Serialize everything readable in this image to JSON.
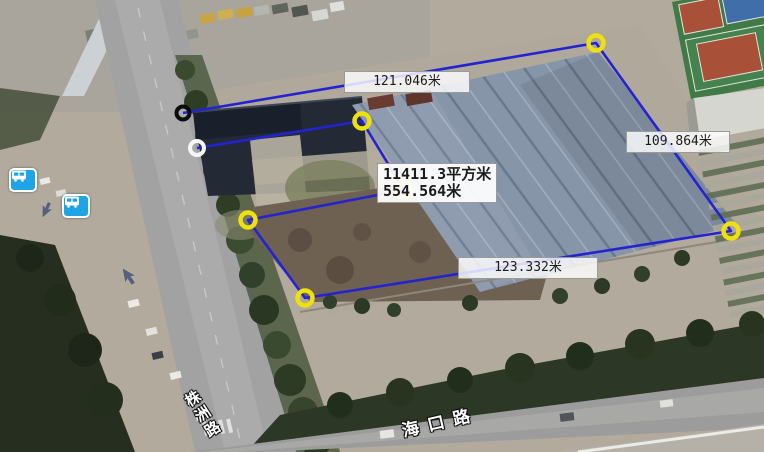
{
  "map": {
    "view": "satellite",
    "measurement": {
      "area_text": "11411.3平方米",
      "perimeter_text": "554.564米",
      "edge_labels": [
        {
          "text": "121.046米"
        },
        {
          "text": "109.864米"
        },
        {
          "text": "123.332米"
        }
      ],
      "line_color": "#2323d2",
      "marker_colors": {
        "start": "#0c0c0c",
        "white": "#f8f8f8",
        "default": "#efe10e"
      },
      "points": [
        [
          183,
          113
        ],
        [
          596,
          43
        ],
        [
          731,
          231
        ],
        [
          305,
          298
        ],
        [
          248,
          220
        ],
        [
          404,
          190
        ],
        [
          362,
          121
        ],
        [
          197,
          148
        ]
      ],
      "markers": [
        {
          "x": 183,
          "y": 113,
          "role": "start-vertex",
          "color": "#0c0c0c",
          "r": 6.5,
          "w": 4
        },
        {
          "x": 197,
          "y": 148,
          "role": "vertex",
          "color": "#f8f8f8",
          "r": 7,
          "w": 4
        },
        {
          "x": 362,
          "y": 121,
          "role": "vertex",
          "color": "#efe10e",
          "r": 7.5,
          "w": 4.5
        },
        {
          "x": 596,
          "y": 43,
          "role": "vertex",
          "color": "#efe10e",
          "r": 7.5,
          "w": 4.5
        },
        {
          "x": 731,
          "y": 231,
          "role": "vertex",
          "color": "#efe10e",
          "r": 7.5,
          "w": 4.5
        },
        {
          "x": 305,
          "y": 298,
          "role": "vertex",
          "color": "#efe10e",
          "r": 7.5,
          "w": 4.5
        },
        {
          "x": 248,
          "y": 220,
          "role": "vertex",
          "color": "#efe10e",
          "r": 7.5,
          "w": 4.5
        },
        {
          "x": 404,
          "y": 190,
          "role": "vertex",
          "color": "#efe10e",
          "r": 7.5,
          "w": 4.5
        }
      ]
    },
    "roads": [
      {
        "name": "海口路"
      },
      {
        "name": "株洲路"
      }
    ],
    "poi_icons": [
      {
        "type": "bus-station"
      },
      {
        "type": "bus-station"
      }
    ]
  }
}
